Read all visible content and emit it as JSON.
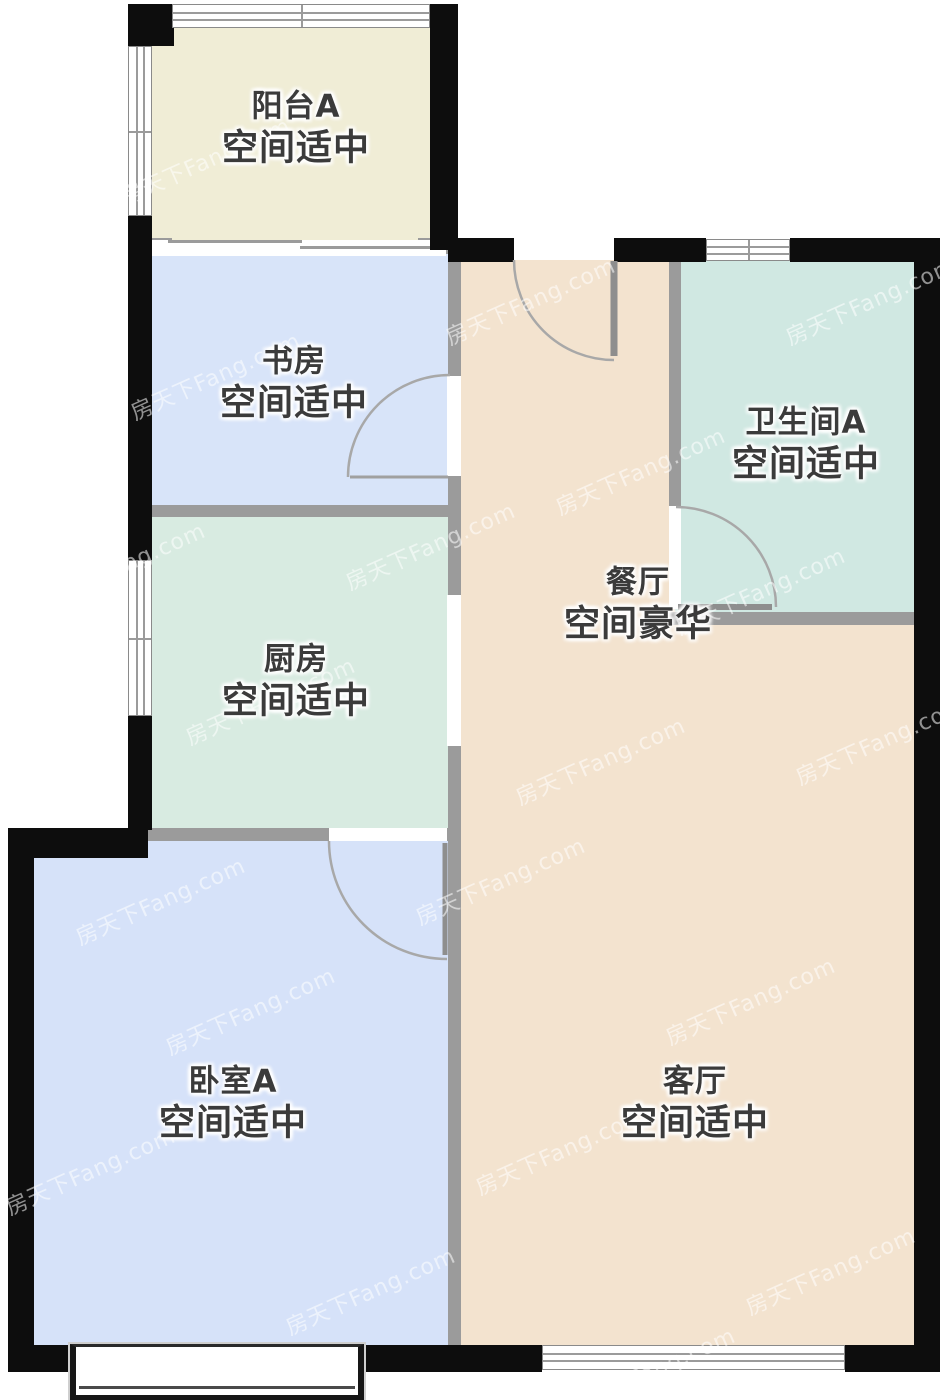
{
  "floorplan": {
    "watermark_text": "房天下Fang.com",
    "rooms": [
      {
        "id": "balcony",
        "name": "阳台A",
        "status": "空间适中"
      },
      {
        "id": "study",
        "name": "书房",
        "status": "空间适中"
      },
      {
        "id": "bathroom",
        "name": "卫生间A",
        "status": "空间适中"
      },
      {
        "id": "dining",
        "name": "餐厅",
        "status": "空间豪华"
      },
      {
        "id": "kitchen",
        "name": "厨房",
        "status": "空间适中"
      },
      {
        "id": "bedroom",
        "name": "卧室A",
        "status": "空间适中"
      },
      {
        "id": "living",
        "name": "客厅",
        "status": "空间适中"
      }
    ],
    "colors": {
      "balcony": "#f0edd6",
      "study": "#d8e4f9",
      "bedroom": "#d6e2f9",
      "kitchen": "#d8ebe1",
      "bathroom": "#d0e8e2",
      "dining_living": "#f3e3cf",
      "outer_wall": "#0d0d0d",
      "inner_wall": "#9b9b9b",
      "label_text": "#3b3b3b"
    }
  }
}
